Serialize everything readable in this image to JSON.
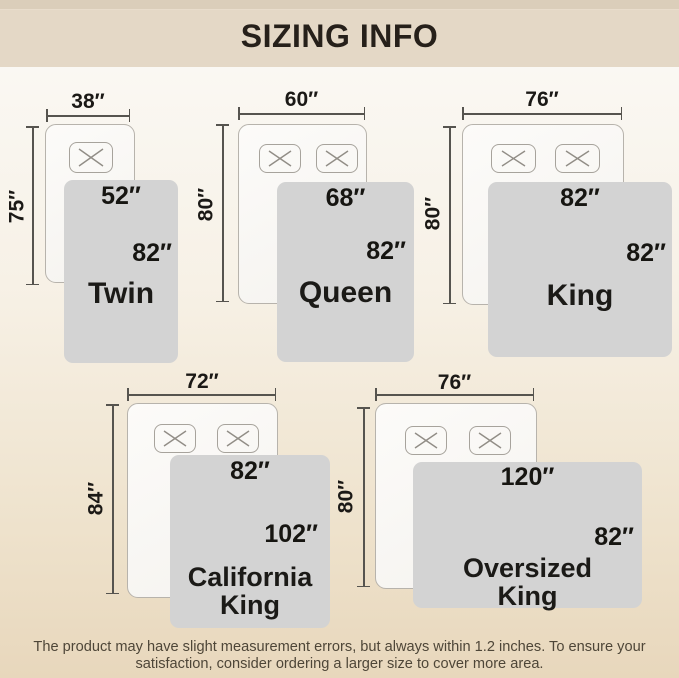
{
  "header": {
    "title": "SIZING INFO"
  },
  "sizes": [
    {
      "name": "Twin",
      "bed_width": "38″",
      "bed_length": "75″",
      "blanket_width": "52″",
      "blanket_length": "82″",
      "pillows": 1
    },
    {
      "name": "Queen",
      "bed_width": "60″",
      "bed_length": "80″",
      "blanket_width": "68″",
      "blanket_length": "82″",
      "pillows": 2
    },
    {
      "name": "King",
      "bed_width": "76″",
      "bed_length": "80″",
      "blanket_width": "82″",
      "blanket_length": "82″",
      "pillows": 2
    },
    {
      "name": "California King",
      "bed_width": "72″",
      "bed_length": "84″",
      "blanket_width": "82″",
      "blanket_length": "102″",
      "pillows": 2
    },
    {
      "name": "Oversized King",
      "bed_width": "76″",
      "bed_length": "80″",
      "blanket_width": "120″",
      "blanket_length": "82″",
      "pillows": 2
    }
  ],
  "footer": {
    "line1": "The product may have slight measurement errors, but always within 1.2 inches. To ensure your",
    "line2": "satisfaction, consider ordering a larger size to cover more area."
  },
  "colors": {
    "header_bg": "#e4d8c6",
    "blanket_fill": "#d3d3d3",
    "measure_line": "#56544f",
    "text_dark": "#1b1916",
    "footer_text": "#4e4638"
  }
}
